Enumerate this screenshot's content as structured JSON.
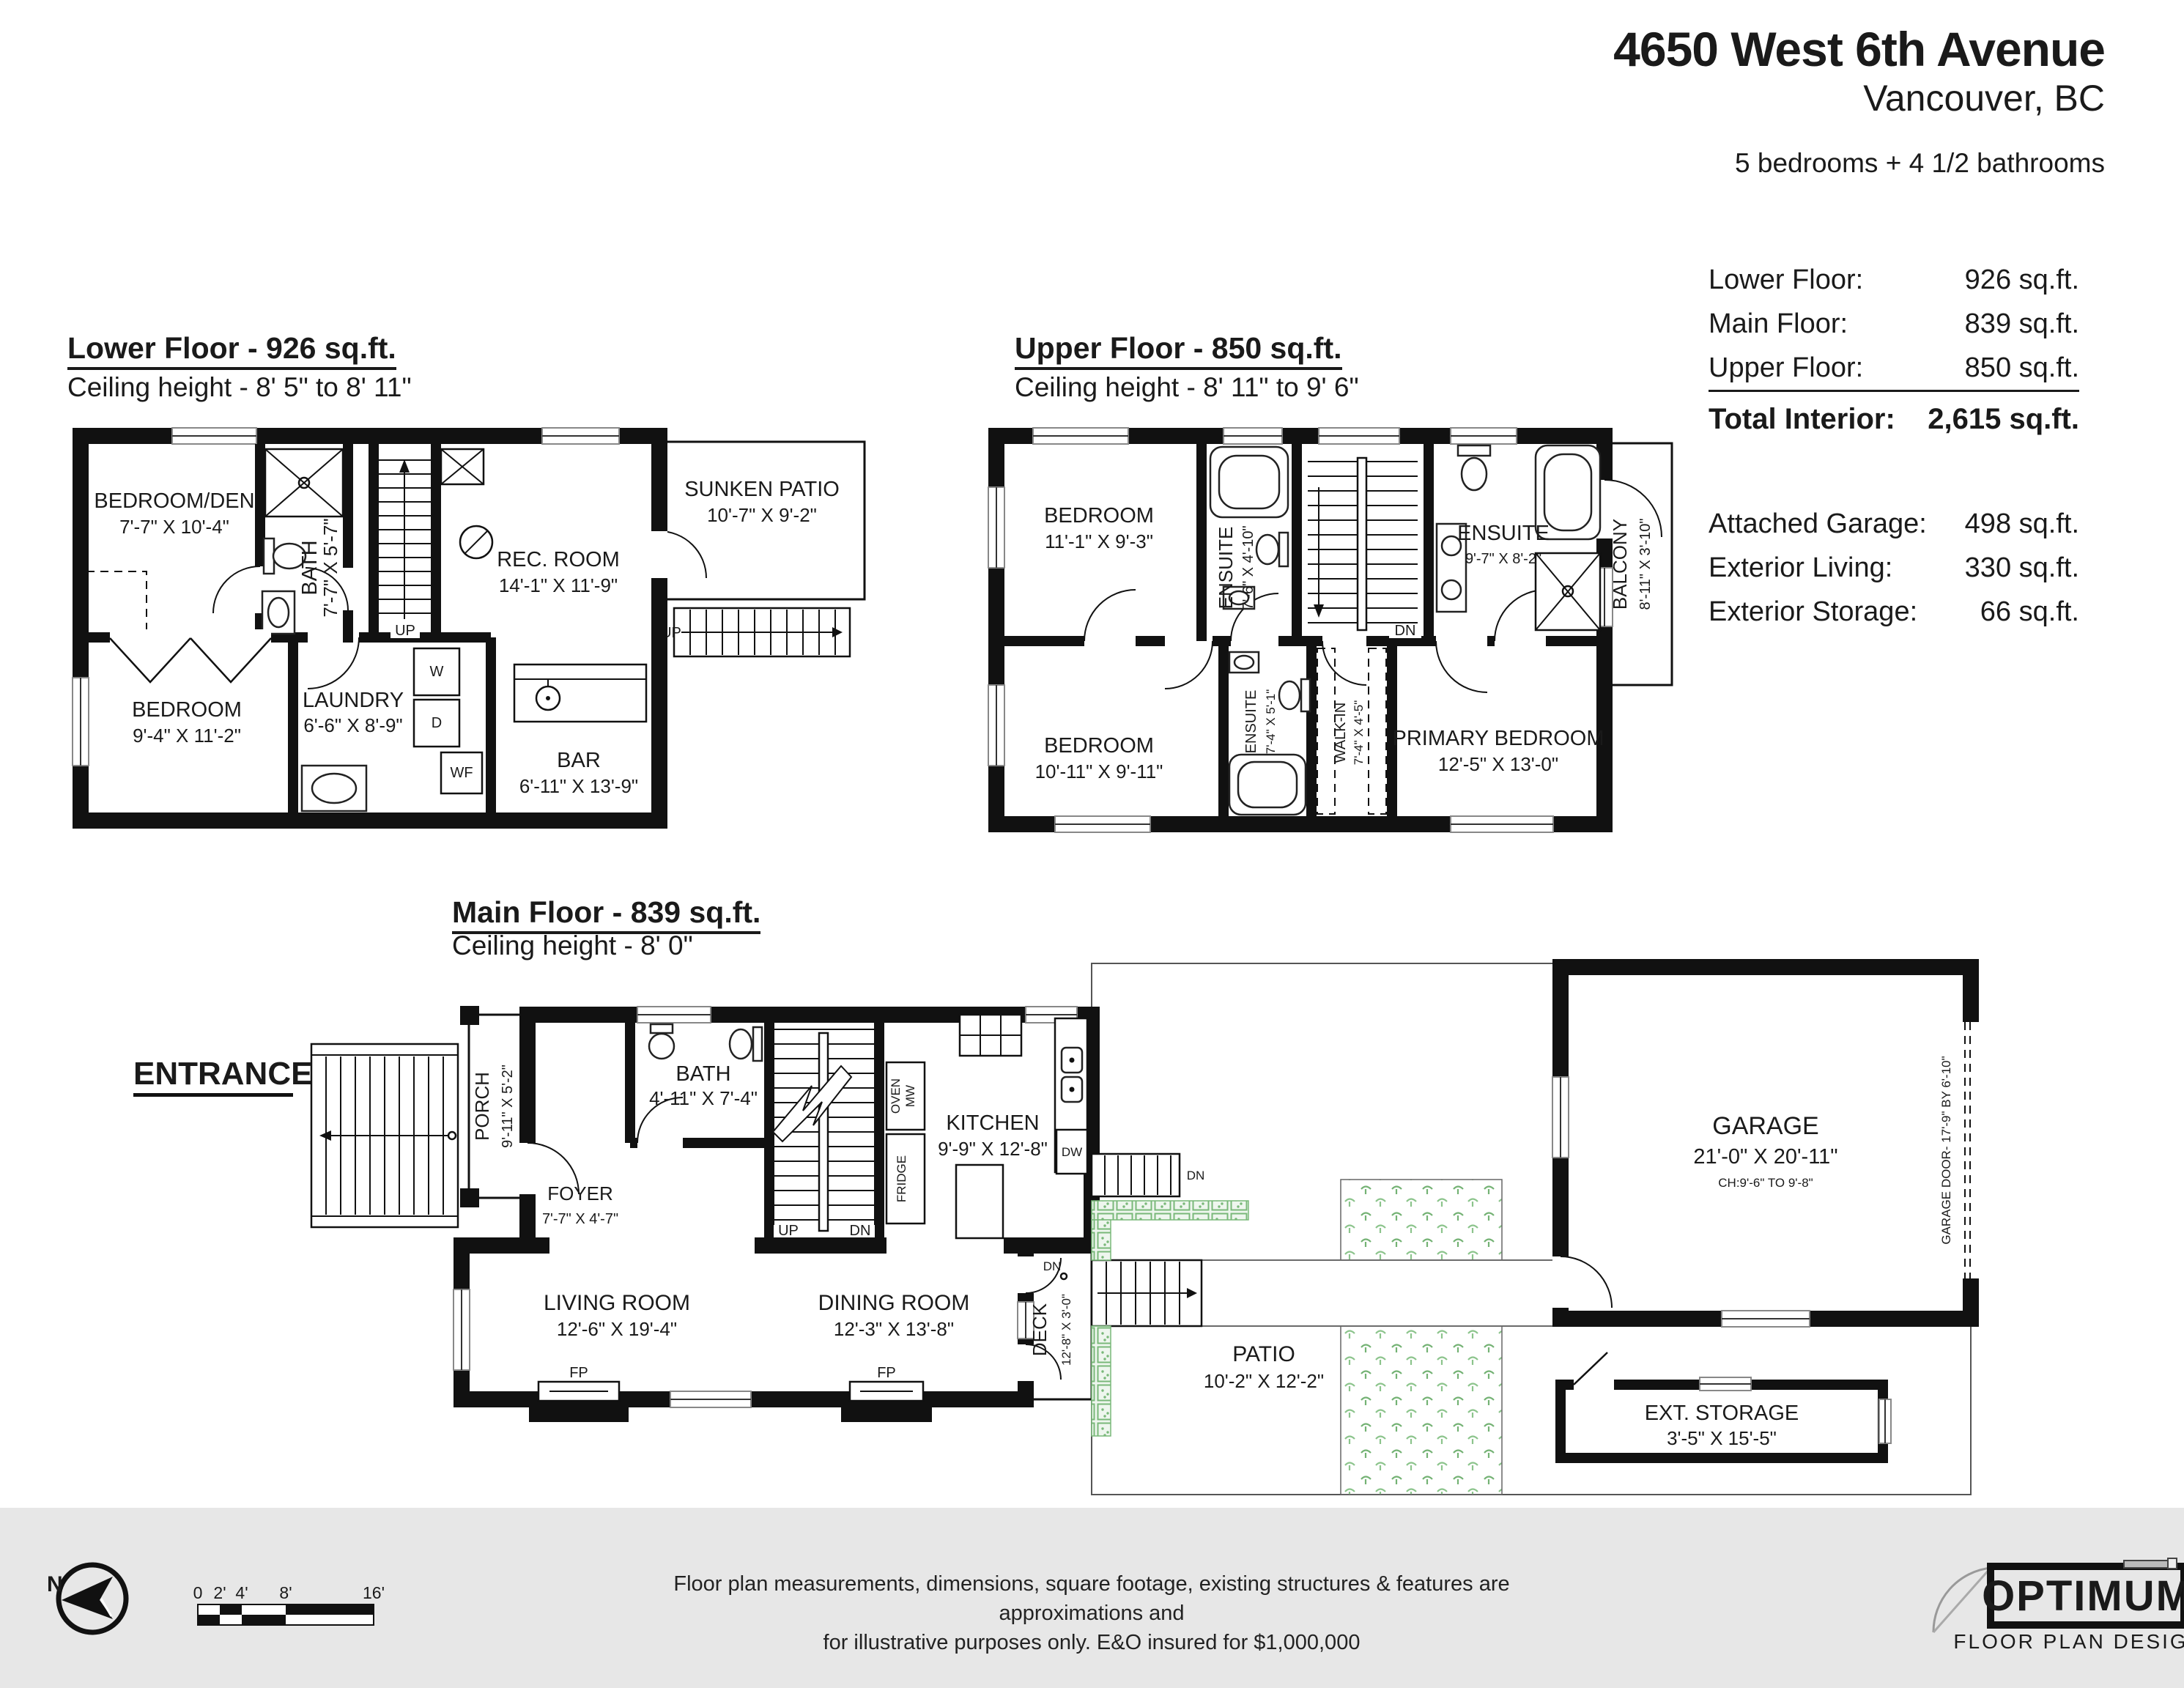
{
  "header": {
    "address_line1": "4650 West 6th Avenue",
    "address_line2": "Vancouver, BC",
    "bed_bath": "5 bedrooms + 4 1/2 bathrooms"
  },
  "stats": {
    "rows": [
      {
        "label": "Lower Floor:",
        "value": "926 sq.ft."
      },
      {
        "label": "Main Floor:",
        "value": "839 sq.ft."
      },
      {
        "label": "Upper Floor:",
        "value": "850 sq.ft."
      }
    ],
    "total": {
      "label": "Total Interior:",
      "value": "2,615 sq.ft."
    },
    "extras": [
      {
        "label": "Attached Garage:",
        "value": "498 sq.ft."
      },
      {
        "label": "Exterior Living:",
        "value": "330 sq.ft."
      },
      {
        "label": "Exterior Storage:",
        "value": "66 sq.ft."
      }
    ]
  },
  "floors": {
    "lower": {
      "title": "Lower Floor - 926 sq.ft.",
      "ceiling": "Ceiling height - 8' 5\" to 8' 11\"",
      "rooms": {
        "bedroom_den": {
          "name": "BEDROOM/DEN",
          "dims": "7'-7\" X 10'-4\""
        },
        "bath": {
          "name": "BATH",
          "dims": "7'-7\" X 5'-7\""
        },
        "rec_room": {
          "name": "REC. ROOM",
          "dims": "14'-1\" X 11'-9\""
        },
        "sunken_patio": {
          "name": "SUNKEN PATIO",
          "dims": "10'-7\" X 9'-2\""
        },
        "bedroom": {
          "name": "BEDROOM",
          "dims": "9'-4\" X 11'-2\""
        },
        "laundry": {
          "name": "LAUNDRY",
          "dims": "6'-6\" X 8'-9\""
        },
        "bar": {
          "name": "BAR",
          "dims": "6'-11\" X 13'-9\""
        }
      },
      "labels": {
        "up": "UP",
        "w": "W",
        "d": "D",
        "wf": "WF"
      }
    },
    "upper": {
      "title": "Upper Floor - 850 sq.ft.",
      "ceiling": "Ceiling height - 8' 11\" to 9' 6\"",
      "rooms": {
        "bedroom1": {
          "name": "BEDROOM",
          "dims": "11'-1\" X 9'-3\""
        },
        "ensuite1": {
          "name": "ENSUITE",
          "dims": "7'-6\" X 4'-10\""
        },
        "ensuite2": {
          "name": "ENSUITE",
          "dims": "9'-7\" X 8'-2\""
        },
        "balcony": {
          "name": "BALCONY",
          "dims": "8'-11\" X 3'-10\""
        },
        "bedroom2": {
          "name": "BEDROOM",
          "dims": "10'-11\" X 9'-11\""
        },
        "ensuite3": {
          "name": "ENSUITE",
          "dims": "7'-4\" X 5'-1\""
        },
        "walkin": {
          "name": "WALK-IN",
          "dims": "7'-4\" X 4'-5\""
        },
        "primary": {
          "name": "PRIMARY BEDROOM",
          "dims": "12'-5\" X 13'-0\""
        }
      },
      "labels": {
        "dn": "DN"
      }
    },
    "main": {
      "title": "Main Floor - 839 sq.ft.",
      "ceiling": "Ceiling height - 8' 0\"",
      "entrance": "ENTRANCE",
      "rooms": {
        "porch": {
          "name": "PORCH",
          "dims": "9'-11\" X 5'-2\""
        },
        "foyer": {
          "name": "FOYER",
          "dims": "7'-7\" X 4'-7\""
        },
        "bath": {
          "name": "BATH",
          "dims": "4'-11\" X 7'-4\""
        },
        "kitchen": {
          "name": "KITCHEN",
          "dims": "9'-9\" X 12'-8\""
        },
        "living": {
          "name": "LIVING ROOM",
          "dims": "12'-6\" X 19'-4\""
        },
        "dining": {
          "name": "DINING ROOM",
          "dims": "12'-3\" X 13'-8\""
        },
        "deck": {
          "name": "DECK",
          "dims": "12'-8\" X 3'-0\""
        },
        "patio": {
          "name": "PATIO",
          "dims": "10'-2\" X 12'-2\""
        },
        "garage": {
          "name": "GARAGE",
          "dims": "21'-0\" X 20'-11\"",
          "ch": "CH:9'-6\" TO 9'-8\"",
          "door": "GARAGE DOOR- 17'-9\" BY 6'-10\""
        },
        "storage": {
          "name": "EXT. STORAGE",
          "dims": "3'-5\" X 15'-5\""
        }
      },
      "labels": {
        "up": "UP",
        "dn": "DN",
        "fp": "FP",
        "oven": "OVEN",
        "mw": "MW",
        "fridge": "FRIDGE",
        "dw": "DW"
      }
    }
  },
  "footer": {
    "north": "N",
    "scale_ticks": [
      "0",
      "2'",
      "4'",
      "8'",
      "16'"
    ],
    "disclaimer1": "Floor plan measurements, dimensions, square footage, existing structures & features are approximations and",
    "disclaimer2": "for illustrative purposes only.  E&O insured for $1,000,000",
    "logo_title": "OPTIMUM",
    "logo_subtitle": "FLOOR PLAN DESIGNS"
  },
  "colors": {
    "ink": "#1a1a1a",
    "footer_bg": "#e7e7e7",
    "hedge_green": "#79b879",
    "sprig_green": "#74b274"
  }
}
